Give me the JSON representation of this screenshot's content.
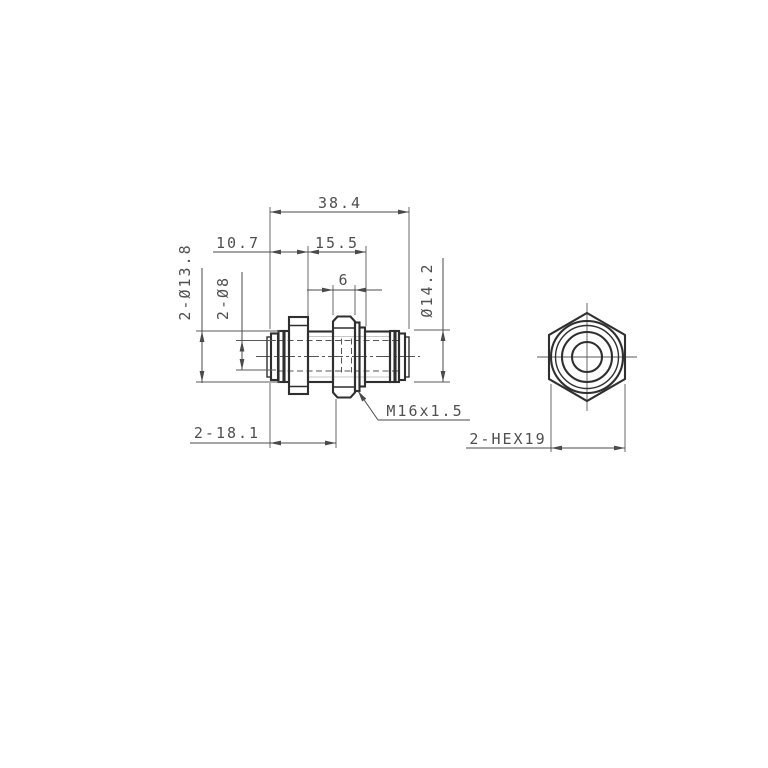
{
  "drawing": {
    "labels": {
      "overall_length": "38.4",
      "cap_section_length": "10.7",
      "thread_section_length": "15.5",
      "hex_nut_width": "6",
      "collet_diameter": "2-Ø13.8",
      "tube_diameter": "2-Ø8",
      "body_diameter": "Ø14.2",
      "end_to_nut_length": "2-18.1",
      "thread_spec": "M16x1.5",
      "hex_size": "2-HEX19"
    },
    "colors": {
      "outline": "#2f2f2f",
      "dimension_lines": "#4a4a4a",
      "dimension_text": "#4f4f4f",
      "hidden_lines": "#555555",
      "background": "#ffffff"
    }
  }
}
